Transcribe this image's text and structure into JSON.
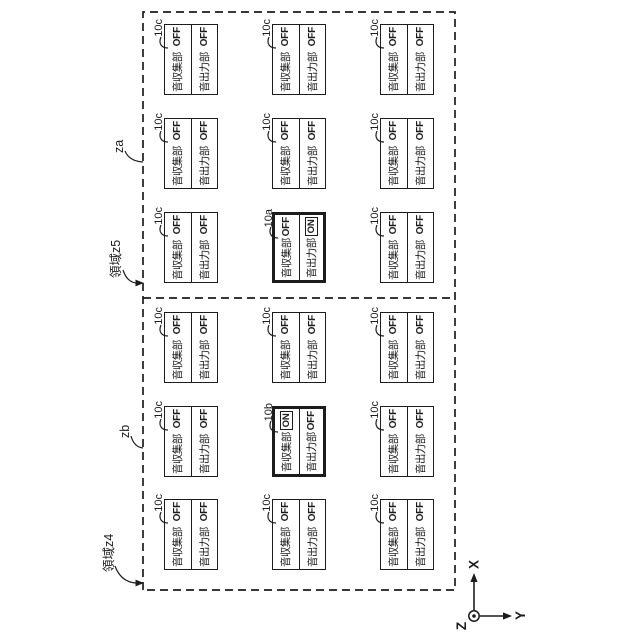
{
  "units": {
    "collect_label": "音収集部",
    "output_label": "音出力部",
    "items": [
      {
        "ref": "10c",
        "col": 0,
        "row": 0,
        "collect": "OFF",
        "output": "OFF",
        "emphasized": false
      },
      {
        "ref": "10c",
        "col": 1,
        "row": 0,
        "collect": "OFF",
        "output": "OFF",
        "emphasized": false
      },
      {
        "ref": "10c",
        "col": 2,
        "row": 0,
        "collect": "OFF",
        "output": "OFF",
        "emphasized": false
      },
      {
        "ref": "10c",
        "col": 0,
        "row": 1,
        "collect": "OFF",
        "output": "OFF",
        "emphasized": false
      },
      {
        "ref": "10b",
        "col": 1,
        "row": 1,
        "collect": "ON",
        "output": "OFF",
        "emphasized": true
      },
      {
        "ref": "10c",
        "col": 2,
        "row": 1,
        "collect": "OFF",
        "output": "OFF",
        "emphasized": false
      },
      {
        "ref": "10c",
        "col": 0,
        "row": 2,
        "collect": "OFF",
        "output": "OFF",
        "emphasized": false
      },
      {
        "ref": "10c",
        "col": 1,
        "row": 2,
        "collect": "OFF",
        "output": "OFF",
        "emphasized": false
      },
      {
        "ref": "10c",
        "col": 2,
        "row": 2,
        "collect": "OFF",
        "output": "OFF",
        "emphasized": false
      },
      {
        "ref": "10c",
        "col": 3,
        "row": 0,
        "collect": "OFF",
        "output": "OFF",
        "emphasized": false
      },
      {
        "ref": "10c",
        "col": 4,
        "row": 0,
        "collect": "OFF",
        "output": "OFF",
        "emphasized": false
      },
      {
        "ref": "10c",
        "col": 5,
        "row": 0,
        "collect": "OFF",
        "output": "OFF",
        "emphasized": false
      },
      {
        "ref": "10a",
        "col": 3,
        "row": 1,
        "collect": "OFF",
        "output": "ON",
        "emphasized": true
      },
      {
        "ref": "10c",
        "col": 4,
        "row": 1,
        "collect": "OFF",
        "output": "OFF",
        "emphasized": false
      },
      {
        "ref": "10c",
        "col": 5,
        "row": 1,
        "collect": "OFF",
        "output": "OFF",
        "emphasized": false
      },
      {
        "ref": "10c",
        "col": 3,
        "row": 2,
        "collect": "OFF",
        "output": "OFF",
        "emphasized": false
      },
      {
        "ref": "10c",
        "col": 4,
        "row": 2,
        "collect": "OFF",
        "output": "OFF",
        "emphasized": false
      },
      {
        "ref": "10c",
        "col": 5,
        "row": 2,
        "collect": "OFF",
        "output": "OFF",
        "emphasized": false
      }
    ]
  },
  "region_labels": {
    "z4_area": "領域z4",
    "zb": "zb",
    "z5_area": "領域z5",
    "za": "za"
  },
  "axes": {
    "x": "X",
    "y": "Y",
    "z": "Z"
  },
  "colors": {
    "line": "#1c1c1c",
    "background": "#ffffff"
  }
}
